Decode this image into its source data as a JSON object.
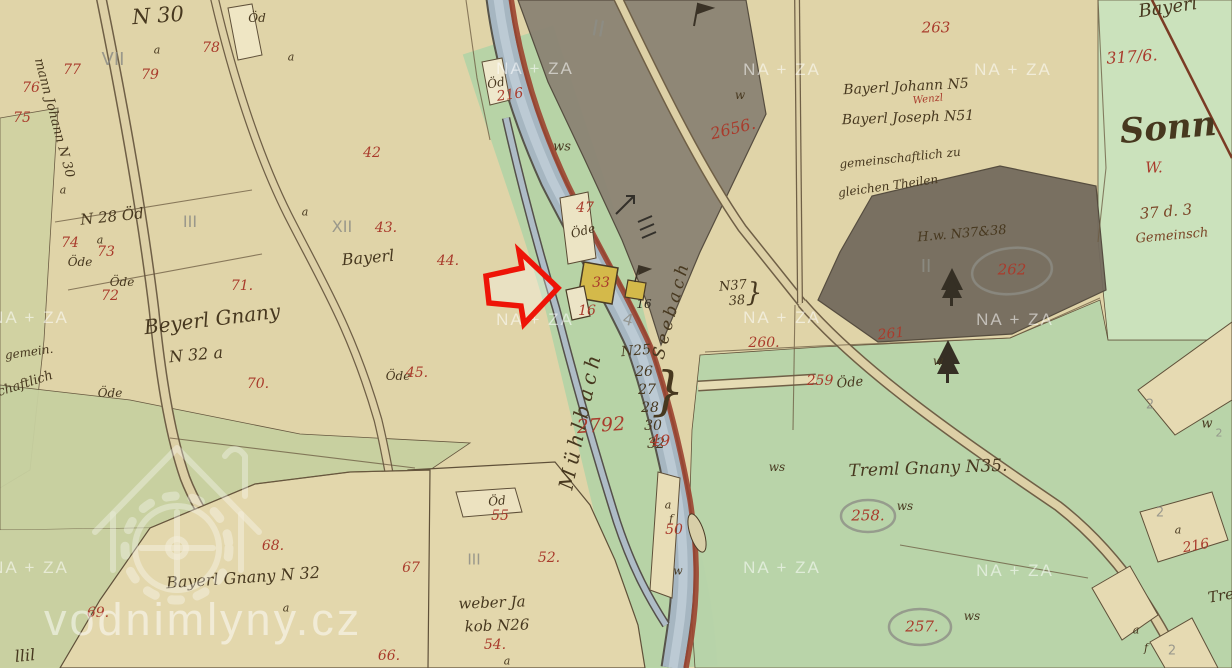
{
  "watermarks": {
    "site": "vodnimlyny.cz",
    "tile_text": "NA + ZA",
    "tiles": [
      {
        "x": 535,
        "y": 69
      },
      {
        "x": 782,
        "y": 70
      },
      {
        "x": 1013,
        "y": 70
      },
      {
        "x": 30,
        "y": 318
      },
      {
        "x": 535,
        "y": 320
      },
      {
        "x": 782,
        "y": 318
      },
      {
        "x": 1015,
        "y": 320
      },
      {
        "x": 30,
        "y": 568
      },
      {
        "x": 782,
        "y": 568
      },
      {
        "x": 1015,
        "y": 571
      }
    ]
  },
  "palette": {
    "red_ink": "#a93b2c",
    "sepia_ink": "#47381f",
    "pencil": "#8e8e86",
    "water": "#a6b6c1",
    "bank_red": "#9c4430",
    "arrow_red": "#ee1407",
    "parcel_tan": "#e0d4a8",
    "meadow_green": "#b8d4aa",
    "dark_parcel": "#8b8374",
    "building_yellow": "#d4b94a"
  },
  "streams": {
    "left_channel": "Mühlbach",
    "right_channel": "Seebach"
  },
  "labels": {
    "items": [
      {
        "id": "n30",
        "t": "N 30",
        "x": 158,
        "y": 16,
        "s": 21,
        "r": -4
      },
      {
        "id": "mann-johann-n30",
        "t": "mann Johann N 30",
        "x": 54,
        "y": 118,
        "s": 13,
        "r": 75
      },
      {
        "id": "n28-oed",
        "t": "N 28 Öd",
        "x": 112,
        "y": 217,
        "s": 15,
        "r": -6
      },
      {
        "id": "beyerl-gnany",
        "t": "Beyerl Gnany",
        "x": 212,
        "y": 319,
        "s": 20,
        "r": -7
      },
      {
        "id": "n32-a",
        "t": "N 32 a",
        "x": 196,
        "y": 355,
        "s": 16,
        "r": -5
      },
      {
        "id": "gemein",
        "t": "gemein.",
        "x": 29,
        "y": 352,
        "s": 12,
        "r": -8
      },
      {
        "id": "schaftlich",
        "t": "schaftlich",
        "x": 22,
        "y": 385,
        "s": 13,
        "r": -18
      },
      {
        "id": "bayerl-43",
        "t": "Bayerl",
        "x": 368,
        "y": 258,
        "s": 16,
        "r": -5
      },
      {
        "id": "bayerl-johann-n5",
        "t": "Bayerl Johann N5",
        "x": 906,
        "y": 87,
        "s": 14,
        "r": -3
      },
      {
        "id": "wenzl",
        "t": "Wenzl",
        "x": 928,
        "y": 100,
        "s": 10,
        "r": -6,
        "c": "red"
      },
      {
        "id": "bayerl-joseph-n51",
        "t": "Bayerl Joseph N51",
        "x": 908,
        "y": 118,
        "s": 14,
        "r": -2
      },
      {
        "id": "gemeinschaftlich-zu",
        "t": "gemeinschaftlich zu",
        "x": 900,
        "y": 158,
        "s": 12,
        "r": -6
      },
      {
        "id": "gleichen-theilen",
        "t": "gleichen Theilen",
        "x": 888,
        "y": 186,
        "s": 12,
        "r": -8
      },
      {
        "id": "hw-n37-38",
        "t": "H.w. N37&38",
        "x": 962,
        "y": 234,
        "s": 13,
        "r": -5
      },
      {
        "id": "treml-gnany-n35",
        "t": "Treml Gnany N35.",
        "x": 928,
        "y": 469,
        "s": 17,
        "r": -2
      },
      {
        "id": "weber-ja",
        "t": "weber Ja",
        "x": 492,
        "y": 603,
        "s": 15,
        "r": -2
      },
      {
        "id": "kob-n26",
        "t": "kob N26",
        "x": 497,
        "y": 626,
        "s": 15,
        "r": -2
      },
      {
        "id": "bayerl-gnany-n32",
        "t": "Bayerl Gnany N 32",
        "x": 243,
        "y": 578,
        "s": 16,
        "r": -4
      },
      {
        "id": "muehlbach",
        "t": "Mühlbach",
        "x": 580,
        "y": 420,
        "s": 20,
        "r": -78,
        "ls": 5
      },
      {
        "id": "seebach",
        "t": "Seebach",
        "x": 672,
        "y": 310,
        "s": 17,
        "r": -75,
        "ls": 4
      },
      {
        "id": "n25",
        "t": "N25",
        "x": 636,
        "y": 351,
        "s": 14,
        "r": -5
      },
      {
        "id": "n25-26",
        "t": "26",
        "x": 644,
        "y": 372
      },
      {
        "id": "n25-27",
        "t": "27",
        "x": 647,
        "y": 390
      },
      {
        "id": "n25-28",
        "t": "28",
        "x": 650,
        "y": 408
      },
      {
        "id": "n25-30",
        "t": "30",
        "x": 653,
        "y": 426
      },
      {
        "id": "n25-32",
        "t": "32",
        "x": 656,
        "y": 444
      },
      {
        "id": "n25-brace",
        "t": "}",
        "x": 668,
        "y": 392,
        "s": 52
      },
      {
        "id": "n37",
        "t": "N37",
        "x": 733,
        "y": 286,
        "s": 13,
        "r": -5
      },
      {
        "id": "n38",
        "t": "38",
        "x": 737,
        "y": 301,
        "s": 13,
        "r": -5
      },
      {
        "id": "n37-brace",
        "t": "}",
        "x": 754,
        "y": 293,
        "s": 26
      },
      {
        "id": "sonn",
        "t": "Sonn",
        "x": 1168,
        "y": 128,
        "s": 34,
        "r": -5,
        "b": true
      },
      {
        "id": "bayerl-top-right",
        "t": "Bayerl",
        "x": 1168,
        "y": 8,
        "s": 18,
        "r": -8
      },
      {
        "id": "d37-3",
        "t": "37 d. 3",
        "x": 1166,
        "y": 212,
        "s": 15,
        "r": -5,
        "c": "brown"
      },
      {
        "id": "gemeinsch",
        "t": "Gemeinsch",
        "x": 1172,
        "y": 236,
        "s": 13,
        "r": -5,
        "c": "brown"
      },
      {
        "id": "tre",
        "t": "Tre",
        "x": 1221,
        "y": 596,
        "s": 15,
        "r": -10
      },
      {
        "id": "llil",
        "t": "llil",
        "x": 25,
        "y": 656,
        "s": 16,
        "r": -6
      },
      {
        "id": "oed-78",
        "t": "Öd",
        "x": 257,
        "y": 18,
        "s": 12
      },
      {
        "id": "oede-74",
        "t": "Öde",
        "x": 80,
        "y": 262,
        "s": 12
      },
      {
        "id": "oede-72",
        "t": "Öde",
        "x": 122,
        "y": 282,
        "s": 12
      },
      {
        "id": "oede-45",
        "t": "Öde",
        "x": 398,
        "y": 376,
        "s": 12
      },
      {
        "id": "oede-70",
        "t": "Öde",
        "x": 110,
        "y": 393,
        "s": 12
      },
      {
        "id": "oede-mill",
        "t": "Öde",
        "x": 583,
        "y": 231,
        "s": 12,
        "r": -15
      },
      {
        "id": "oed-216",
        "t": "Öd",
        "x": 496,
        "y": 83,
        "s": 12,
        "r": -10
      },
      {
        "id": "oede-259",
        "t": "Öde",
        "x": 850,
        "y": 383,
        "s": 13,
        "r": -5
      },
      {
        "id": "oed-55",
        "t": "Öd",
        "x": 497,
        "y": 501,
        "s": 12,
        "r": -5
      },
      {
        "id": "ws-1",
        "t": "ws",
        "x": 562,
        "y": 147,
        "s": 13
      },
      {
        "id": "ws-2",
        "t": "ws",
        "x": 777,
        "y": 467,
        "s": 12
      },
      {
        "id": "ws-3",
        "t": "ws",
        "x": 905,
        "y": 506,
        "s": 12
      },
      {
        "id": "ws-4",
        "t": "ws",
        "x": 972,
        "y": 616,
        "s": 12
      },
      {
        "id": "w-1",
        "t": "w",
        "x": 740,
        "y": 95,
        "s": 12
      },
      {
        "id": "w-tree",
        "t": "w",
        "x": 938,
        "y": 361,
        "s": 12
      },
      {
        "id": "w-right",
        "t": "w",
        "x": 1207,
        "y": 424,
        "s": 13
      },
      {
        "id": "a-1",
        "t": "a",
        "x": 157,
        "y": 50,
        "s": 11
      },
      {
        "id": "a-2",
        "t": "a",
        "x": 291,
        "y": 57,
        "s": 11
      },
      {
        "id": "a-3",
        "t": "a",
        "x": 63,
        "y": 190,
        "s": 11
      },
      {
        "id": "a-4",
        "t": "a",
        "x": 100,
        "y": 240,
        "s": 11
      },
      {
        "id": "a-5",
        "t": "a",
        "x": 305,
        "y": 212,
        "s": 11
      },
      {
        "id": "a-6",
        "t": "a",
        "x": 286,
        "y": 608,
        "s": 11
      },
      {
        "id": "a-7",
        "t": "a",
        "x": 507,
        "y": 661,
        "s": 11
      },
      {
        "id": "a-8",
        "t": "a",
        "x": 668,
        "y": 505,
        "s": 11
      },
      {
        "id": "f-8",
        "t": "f",
        "x": 671,
        "y": 519,
        "s": 11
      },
      {
        "id": "w-sliver",
        "t": "w",
        "x": 678,
        "y": 571,
        "s": 11
      },
      {
        "id": "a-9",
        "t": "a",
        "x": 1178,
        "y": 530,
        "s": 11
      },
      {
        "id": "a-10",
        "t": "a",
        "x": 1136,
        "y": 630,
        "s": 11
      },
      {
        "id": "f-10",
        "t": "f",
        "x": 1146,
        "y": 648,
        "s": 11
      },
      {
        "id": "b16",
        "t": "16",
        "x": 644,
        "y": 304,
        "s": 12,
        "c": "black"
      },
      {
        "id": "r75",
        "t": "75",
        "x": 22,
        "y": 118,
        "c": "red"
      },
      {
        "id": "r76",
        "t": "76",
        "x": 31,
        "y": 88,
        "c": "red"
      },
      {
        "id": "r77",
        "t": "77",
        "x": 72,
        "y": 70,
        "c": "red"
      },
      {
        "id": "r78",
        "t": "78",
        "x": 211,
        "y": 48,
        "c": "red"
      },
      {
        "id": "r79",
        "t": "79",
        "x": 150,
        "y": 75,
        "c": "red"
      },
      {
        "id": "r74",
        "t": "74",
        "x": 70,
        "y": 243,
        "c": "red"
      },
      {
        "id": "r73",
        "t": "73",
        "x": 106,
        "y": 252,
        "c": "red"
      },
      {
        "id": "r72",
        "t": "72",
        "x": 110,
        "y": 296,
        "c": "red"
      },
      {
        "id": "r71",
        "t": "71.",
        "x": 242,
        "y": 286,
        "c": "red"
      },
      {
        "id": "r70",
        "t": "70.",
        "x": 258,
        "y": 384,
        "c": "red"
      },
      {
        "id": "r45",
        "t": "45.",
        "x": 417,
        "y": 373,
        "c": "red"
      },
      {
        "id": "r42",
        "t": "42",
        "x": 372,
        "y": 153,
        "c": "red"
      },
      {
        "id": "r43",
        "t": "43.",
        "x": 386,
        "y": 228,
        "c": "red"
      },
      {
        "id": "r44",
        "t": "44.",
        "x": 448,
        "y": 261,
        "c": "red"
      },
      {
        "id": "r68",
        "t": "68.",
        "x": 273,
        "y": 546,
        "c": "red"
      },
      {
        "id": "r69",
        "t": "69.",
        "x": 98,
        "y": 613,
        "c": "red"
      },
      {
        "id": "r66",
        "t": "66.",
        "x": 389,
        "y": 656,
        "c": "red"
      },
      {
        "id": "r67",
        "t": "67",
        "x": 411,
        "y": 568,
        "c": "red"
      },
      {
        "id": "r55",
        "t": "55",
        "x": 500,
        "y": 516,
        "c": "red"
      },
      {
        "id": "r52",
        "t": "52.",
        "x": 549,
        "y": 558,
        "c": "red"
      },
      {
        "id": "r54",
        "t": "54.",
        "x": 495,
        "y": 645,
        "c": "red"
      },
      {
        "id": "r47",
        "t": "47",
        "x": 585,
        "y": 208,
        "c": "red"
      },
      {
        "id": "r33",
        "t": "33",
        "x": 601,
        "y": 283,
        "c": "red"
      },
      {
        "id": "r16",
        "t": "16",
        "x": 587,
        "y": 311,
        "c": "red"
      },
      {
        "id": "r50",
        "t": "50",
        "x": 674,
        "y": 530,
        "c": "red"
      },
      {
        "id": "r216a",
        "t": "216",
        "x": 510,
        "y": 95,
        "r": -8,
        "c": "red"
      },
      {
        "id": "r2656",
        "t": "2656.",
        "x": 733,
        "y": 129,
        "s": 16,
        "r": -14,
        "c": "red"
      },
      {
        "id": "r263",
        "t": "263",
        "x": 936,
        "y": 28,
        "s": 15,
        "c": "red"
      },
      {
        "id": "r3176",
        "t": "317/6.",
        "x": 1132,
        "y": 57,
        "s": 16,
        "r": -4,
        "c": "red"
      },
      {
        "id": "rW",
        "t": "W.",
        "x": 1154,
        "y": 168,
        "s": 15,
        "c": "red"
      },
      {
        "id": "r262",
        "t": "262",
        "x": 1012,
        "y": 270,
        "s": 15,
        "c": "red"
      },
      {
        "id": "r261",
        "t": "261",
        "x": 891,
        "y": 334,
        "r": -6,
        "c": "red"
      },
      {
        "id": "r260",
        "t": "260.",
        "x": 764,
        "y": 343,
        "c": "red"
      },
      {
        "id": "r259",
        "t": "259",
        "x": 820,
        "y": 381,
        "c": "red"
      },
      {
        "id": "r258",
        "t": "258.",
        "x": 868,
        "y": 516,
        "s": 15,
        "c": "red"
      },
      {
        "id": "r257",
        "t": "257.",
        "x": 922,
        "y": 627,
        "s": 15,
        "c": "red"
      },
      {
        "id": "r2792",
        "t": "2792",
        "x": 601,
        "y": 426,
        "s": 19,
        "r": -4,
        "c": "red"
      },
      {
        "id": "r49",
        "t": "49",
        "x": 660,
        "y": 441,
        "s": 16,
        "c": "red"
      },
      {
        "id": "r216b",
        "t": "216",
        "x": 1196,
        "y": 546,
        "r": -10,
        "c": "red"
      },
      {
        "id": "pVII",
        "t": "VII",
        "x": 113,
        "y": 60,
        "s": 18,
        "c": "pencil"
      },
      {
        "id": "pIII",
        "t": "III",
        "x": 190,
        "y": 222,
        "s": 16,
        "c": "pencil"
      },
      {
        "id": "pXII",
        "t": "XII",
        "x": 342,
        "y": 227,
        "s": 16,
        "c": "pencil"
      },
      {
        "id": "pII-1",
        "t": "II",
        "x": 598,
        "y": 30,
        "s": 22,
        "r": 10,
        "c": "pencil"
      },
      {
        "id": "pII-2",
        "t": "II",
        "x": 926,
        "y": 267,
        "s": 18,
        "c": "pencil"
      },
      {
        "id": "p4",
        "t": "4",
        "x": 628,
        "y": 320,
        "s": 16,
        "r": 15,
        "c": "pencil"
      },
      {
        "id": "pIII-weber",
        "t": "III",
        "x": 474,
        "y": 560,
        "s": 15,
        "c": "pencil"
      },
      {
        "id": "p2-a",
        "t": "2",
        "x": 1150,
        "y": 405,
        "s": 13,
        "c": "pencil"
      },
      {
        "id": "p2-b",
        "t": "2",
        "x": 1160,
        "y": 513,
        "s": 13,
        "c": "pencil"
      },
      {
        "id": "p2-c",
        "t": "2",
        "x": 1172,
        "y": 651,
        "s": 13,
        "c": "pencil"
      },
      {
        "id": "p2-d",
        "t": "2",
        "x": 1219,
        "y": 433,
        "s": 11,
        "c": "pencil"
      }
    ]
  }
}
